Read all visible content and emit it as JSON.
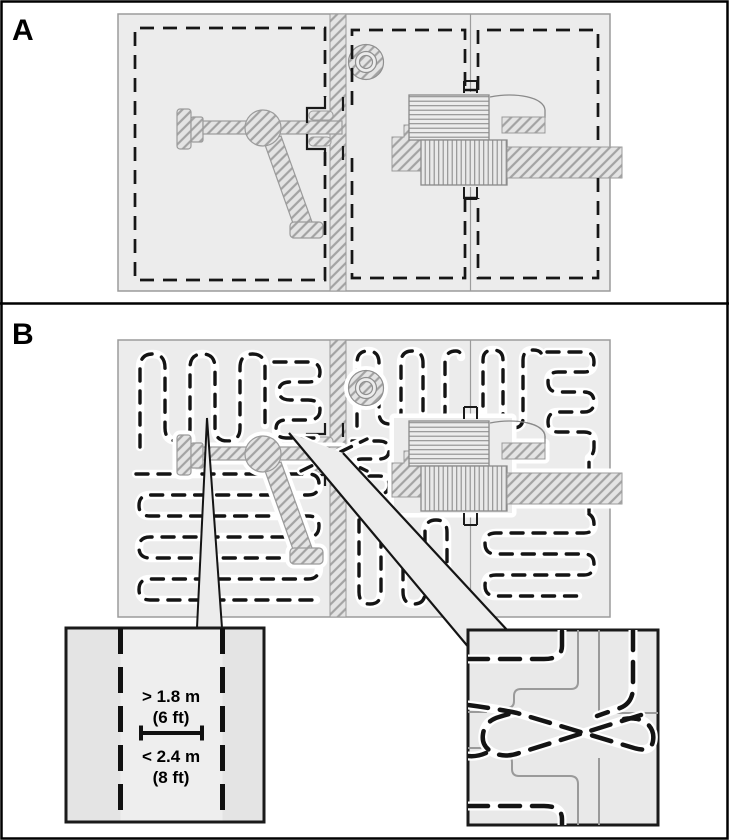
{
  "figure": {
    "panel_a": {
      "label": "A"
    },
    "panel_b": {
      "label": "B"
    },
    "inset_lane": {
      "min_spacing": "> 1.8 m",
      "min_spacing_ft": "(6 ft)",
      "max_width": "< 2.4 m",
      "max_width_ft": "(8 ft)"
    },
    "colors": {
      "background": "#ffffff",
      "field_fill": "#ececec",
      "sketch_line": "#8f8f8f",
      "hatch_line": "#a3a3a3",
      "boundary_line": "#161616",
      "inset_fill": "#e4e4e4"
    }
  }
}
